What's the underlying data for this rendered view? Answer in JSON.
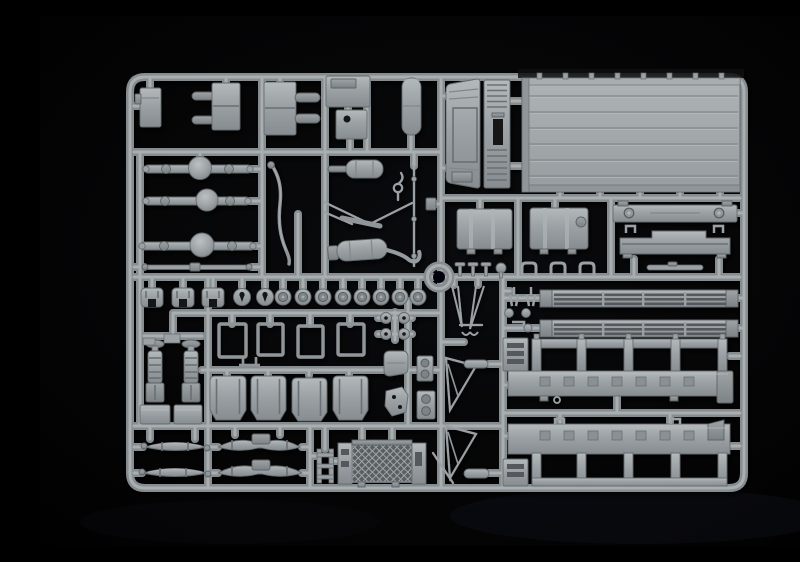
{
  "scene": {
    "description": "Photograph of a grey injection-molded plastic model kit sprue (parts tree) for a military truck kit, lying on a black background",
    "object": "styrene sprue frame with attached unassembled truck parts",
    "material": "grey styrene plastic",
    "background": "black studio backdrop"
  },
  "colors": {
    "background": "#050506",
    "plastic": "#9aa0a3",
    "plastic_highlight": "#b4b9bb",
    "plastic_shadow": "#70767a",
    "runner": "#868c8f",
    "runner_light": "#a9aeb1",
    "recess_dark": "#55595c",
    "hole_dark": "#141618"
  },
  "parts": [
    "sprue-frame",
    "center-locating-ring",
    "cargo-bed-floor-panel",
    "cab-back-panel",
    "front-grille-panel",
    "storage-box",
    "bracket-with-pins",
    "bracket-with-studs",
    "box-with-hatch",
    "box-with-hole",
    "tall-canister",
    "front-axle",
    "middle-axle",
    "rear-axle",
    "drive-shaft",
    "exhaust-downpipe",
    "muffler",
    "muffler-with-tailpipe",
    "tow-hook",
    "frame-braces",
    "torsion-bar",
    "fuel-tank-left",
    "fuel-tank-right",
    "front-bumper",
    "rear-crossmember",
    "door-handle-bar",
    "fender-arches",
    "keyhole-discs",
    "wheel-hubs",
    "t-pins",
    "u-clips",
    "pulley-wheels",
    "seat-cushion",
    "headlight-plates",
    "angle-bracket",
    "window-frames",
    "seat-backs",
    "shock-absorbers",
    "stowage-boxes",
    "wiper-arms",
    "small-clamps",
    "side-rail-upper",
    "side-rail-lower",
    "stake-panel-upper",
    "stake-panel-lower",
    "end-ladder-pieces",
    "leaf-springs",
    "spring-assemblies",
    "step-ladder-part",
    "radiator-with-mesh",
    "tie-rod",
    "mirror-brackets",
    "mirror-caps"
  ]
}
